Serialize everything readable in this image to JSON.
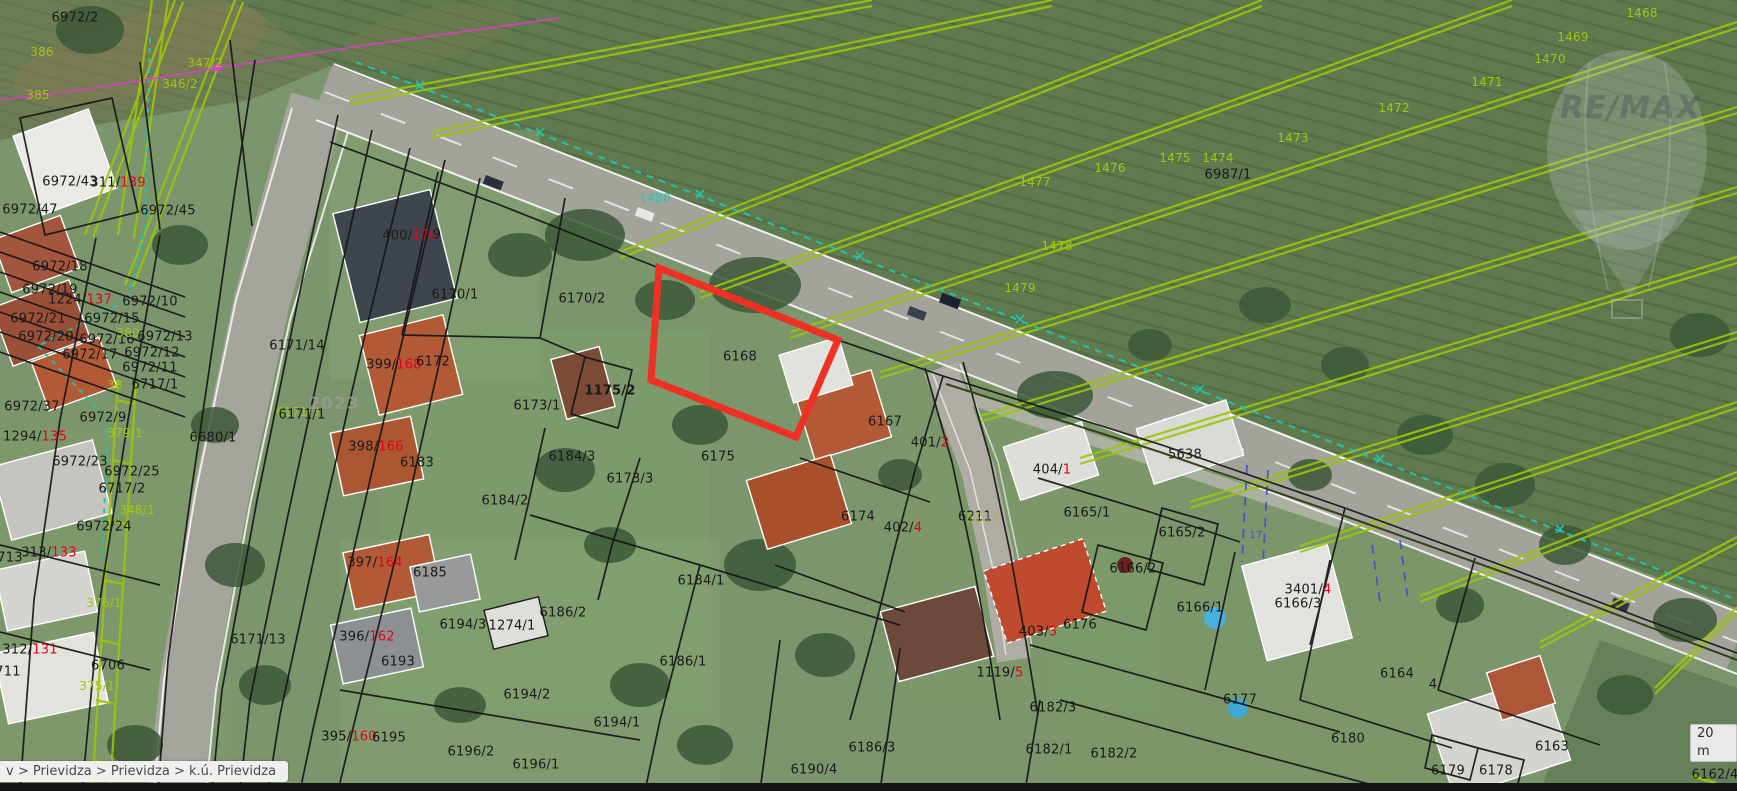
{
  "app": {
    "type": "cadastral-map-viewer"
  },
  "statusbar": {
    "breadcrumb": "v > Prievidza > Prievidza > k.ú. Prievidza"
  },
  "scale_indicator": {
    "label": "20 m"
  },
  "watermarks": {
    "brand": "RE/MAX",
    "imagery_year": "2023"
  },
  "map": {
    "highlight_parcel": {
      "id": "6168",
      "color": "#ee3124",
      "polygon": [
        [
          659,
          268
        ],
        [
          838,
          340
        ],
        [
          796,
          437
        ],
        [
          651,
          380
        ]
      ]
    },
    "label_colors": {
      "black": "#1a1a1a",
      "red": "#e4001f",
      "green": "#9fc80e",
      "teal": "#2bc4b2",
      "blue": "#4444cc"
    },
    "labels": [
      {
        "x": 75,
        "y": 18,
        "p": [
          [
            "6972/2",
            "black"
          ]
        ]
      },
      {
        "x": 70,
        "y": 182,
        "p": [
          [
            "6972/43",
            "black"
          ]
        ]
      },
      {
        "x": 118,
        "y": 183,
        "p": [
          [
            "311/",
            "black"
          ],
          [
            "139",
            "red"
          ]
        ]
      },
      {
        "x": 30,
        "y": 210,
        "p": [
          [
            "6972/47",
            "black"
          ]
        ]
      },
      {
        "x": 168,
        "y": 211,
        "p": [
          [
            "6972/45",
            "black"
          ]
        ]
      },
      {
        "x": 60,
        "y": 267,
        "p": [
          [
            "6972/18",
            "black"
          ]
        ]
      },
      {
        "x": 50,
        "y": 290,
        "p": [
          [
            "6972/19",
            "black"
          ]
        ]
      },
      {
        "x": 80,
        "y": 300,
        "p": [
          [
            "1224/",
            "black"
          ],
          [
            "137",
            "red"
          ]
        ]
      },
      {
        "x": 150,
        "y": 302,
        "p": [
          [
            "6972/10",
            "black"
          ]
        ]
      },
      {
        "x": 38,
        "y": 319,
        "p": [
          [
            "6972/21",
            "black"
          ]
        ]
      },
      {
        "x": 112,
        "y": 319,
        "p": [
          [
            "6972/15",
            "black"
          ]
        ]
      },
      {
        "x": 46,
        "y": 337,
        "p": [
          [
            "6972/20",
            "black"
          ]
        ]
      },
      {
        "x": 107,
        "y": 340,
        "p": [
          [
            "6972/16",
            "black"
          ]
        ]
      },
      {
        "x": 165,
        "y": 337,
        "p": [
          [
            "6972/13",
            "black"
          ]
        ]
      },
      {
        "x": 90,
        "y": 355,
        "p": [
          [
            "6972/17",
            "black"
          ]
        ]
      },
      {
        "x": 152,
        "y": 353,
        "p": [
          [
            "6972/12",
            "black"
          ]
        ]
      },
      {
        "x": 150,
        "y": 368,
        "p": [
          [
            "6972/11",
            "black"
          ]
        ]
      },
      {
        "x": 155,
        "y": 385,
        "p": [
          [
            "6717/1",
            "black"
          ]
        ]
      },
      {
        "x": 297,
        "y": 346,
        "p": [
          [
            "6171/14",
            "black"
          ]
        ]
      },
      {
        "x": 298,
        "y": 412,
        "p": [
          [
            "6171/3",
            "green"
          ]
        ],
        "s": 12
      },
      {
        "x": 302,
        "y": 415,
        "p": [
          [
            "6171/1",
            "black"
          ]
        ]
      },
      {
        "x": 32,
        "y": 407,
        "p": [
          [
            "6972/37",
            "black"
          ]
        ]
      },
      {
        "x": 35,
        "y": 437,
        "p": [
          [
            "1294/",
            "black"
          ],
          [
            "135",
            "red"
          ]
        ]
      },
      {
        "x": 103,
        "y": 418,
        "p": [
          [
            "6972/9",
            "black"
          ]
        ]
      },
      {
        "x": 213,
        "y": 438,
        "p": [
          [
            "6680/1",
            "black"
          ]
        ]
      },
      {
        "x": 80,
        "y": 462,
        "p": [
          [
            "6972/23",
            "black"
          ]
        ]
      },
      {
        "x": 132,
        "y": 472,
        "p": [
          [
            "6972/25",
            "black"
          ]
        ]
      },
      {
        "x": 122,
        "y": 489,
        "p": [
          [
            "6717/2",
            "black"
          ]
        ]
      },
      {
        "x": 104,
        "y": 527,
        "p": [
          [
            "6972/24",
            "black"
          ]
        ]
      },
      {
        "x": 10,
        "y": 558,
        "p": [
          [
            "713",
            "black"
          ]
        ]
      },
      {
        "x": 49,
        "y": 553,
        "p": [
          [
            "313/",
            "black"
          ],
          [
            "133",
            "red"
          ]
        ]
      },
      {
        "x": 30,
        "y": 650,
        "p": [
          [
            "312/",
            "black"
          ],
          [
            "131",
            "red"
          ]
        ]
      },
      {
        "x": 8,
        "y": 672,
        "p": [
          [
            "711",
            "black"
          ]
        ]
      },
      {
        "x": 108,
        "y": 666,
        "p": [
          [
            "6706",
            "black"
          ]
        ]
      },
      {
        "x": 258,
        "y": 640,
        "p": [
          [
            "6171/13",
            "black"
          ]
        ]
      },
      {
        "x": 410,
        "y": 236,
        "p": [
          [
            "400/",
            "black"
          ],
          [
            "170",
            "red"
          ]
        ]
      },
      {
        "x": 437,
        "y": 235,
        "p": [
          [
            "9",
            "black"
          ]
        ]
      },
      {
        "x": 455,
        "y": 295,
        "p": [
          [
            "6170/1",
            "black"
          ]
        ]
      },
      {
        "x": 582,
        "y": 299,
        "p": [
          [
            "6170/2",
            "black"
          ]
        ]
      },
      {
        "x": 394,
        "y": 365,
        "p": [
          [
            "399/",
            "black"
          ],
          [
            "168",
            "red"
          ]
        ]
      },
      {
        "x": 433,
        "y": 362,
        "p": [
          [
            "6172",
            "black"
          ]
        ]
      },
      {
        "x": 610,
        "y": 391,
        "p": [
          [
            "1175/2",
            "black"
          ]
        ],
        "b": 1
      },
      {
        "x": 537,
        "y": 406,
        "p": [
          [
            "6173/1",
            "black"
          ]
        ]
      },
      {
        "x": 740,
        "y": 357,
        "p": [
          [
            "6168",
            "black"
          ]
        ]
      },
      {
        "x": 572,
        "y": 457,
        "p": [
          [
            "6184/3",
            "black"
          ]
        ]
      },
      {
        "x": 630,
        "y": 479,
        "p": [
          [
            "6173/3",
            "black"
          ]
        ]
      },
      {
        "x": 718,
        "y": 457,
        "p": [
          [
            "6175",
            "black"
          ]
        ]
      },
      {
        "x": 376,
        "y": 447,
        "p": [
          [
            "398/",
            "black"
          ],
          [
            "166",
            "red"
          ]
        ]
      },
      {
        "x": 417,
        "y": 463,
        "p": [
          [
            "6183",
            "black"
          ]
        ]
      },
      {
        "x": 505,
        "y": 501,
        "p": [
          [
            "6184/2",
            "black"
          ]
        ]
      },
      {
        "x": 885,
        "y": 422,
        "p": [
          [
            "6167",
            "black"
          ]
        ]
      },
      {
        "x": 930,
        "y": 443,
        "p": [
          [
            "401/",
            "black"
          ],
          [
            "2",
            "red"
          ]
        ]
      },
      {
        "x": 858,
        "y": 517,
        "p": [
          [
            "6174",
            "black"
          ]
        ]
      },
      {
        "x": 903,
        "y": 528,
        "p": [
          [
            "402/",
            "black"
          ],
          [
            "4",
            "red"
          ]
        ]
      },
      {
        "x": 975,
        "y": 517,
        "p": [
          [
            "6211",
            "black"
          ]
        ]
      },
      {
        "x": 983,
        "y": 519,
        "p": [
          [
            "6211",
            "green"
          ]
        ],
        "o": 0.6
      },
      {
        "x": 1052,
        "y": 470,
        "p": [
          [
            "404/",
            "black"
          ],
          [
            "1",
            "red"
          ]
        ]
      },
      {
        "x": 1185,
        "y": 455,
        "p": [
          [
            "5638",
            "black"
          ]
        ]
      },
      {
        "x": 1087,
        "y": 513,
        "p": [
          [
            "6165/1",
            "black"
          ]
        ]
      },
      {
        "x": 1182,
        "y": 533,
        "p": [
          [
            "6165/2",
            "black"
          ]
        ]
      },
      {
        "x": 1133,
        "y": 569,
        "p": [
          [
            "6166/2",
            "black"
          ]
        ]
      },
      {
        "x": 1308,
        "y": 590,
        "p": [
          [
            "3401/",
            "black"
          ],
          [
            "4",
            "red"
          ]
        ]
      },
      {
        "x": 1298,
        "y": 604,
        "p": [
          [
            "6166/3",
            "black"
          ]
        ]
      },
      {
        "x": 1200,
        "y": 608,
        "p": [
          [
            "6166/1",
            "black"
          ]
        ]
      },
      {
        "x": 1080,
        "y": 625,
        "p": [
          [
            "6176",
            "black"
          ]
        ]
      },
      {
        "x": 1038,
        "y": 632,
        "p": [
          [
            "403/",
            "black"
          ],
          [
            "3",
            "red"
          ]
        ]
      },
      {
        "x": 1000,
        "y": 673,
        "p": [
          [
            "1119/",
            "black"
          ],
          [
            "5",
            "red"
          ]
        ]
      },
      {
        "x": 1053,
        "y": 708,
        "p": [
          [
            "6182/3",
            "black"
          ]
        ]
      },
      {
        "x": 1240,
        "y": 700,
        "p": [
          [
            "6177",
            "black"
          ]
        ]
      },
      {
        "x": 1348,
        "y": 739,
        "p": [
          [
            "6180",
            "black"
          ]
        ]
      },
      {
        "x": 1397,
        "y": 674,
        "p": [
          [
            "6164",
            "black"
          ]
        ]
      },
      {
        "x": 1552,
        "y": 747,
        "p": [
          [
            "6163",
            "black"
          ]
        ]
      },
      {
        "x": 1448,
        "y": 771,
        "p": [
          [
            "6179",
            "black"
          ]
        ]
      },
      {
        "x": 1496,
        "y": 771,
        "p": [
          [
            "6178",
            "black"
          ]
        ]
      },
      {
        "x": 1715,
        "y": 775,
        "p": [
          [
            "6162/4",
            "black"
          ]
        ]
      },
      {
        "x": 1433,
        "y": 685,
        "p": [
          [
            "4",
            "black"
          ]
        ]
      },
      {
        "x": 1228,
        "y": 175,
        "p": [
          [
            "6987/1",
            "black"
          ]
        ]
      },
      {
        "x": 375,
        "y": 563,
        "p": [
          [
            "397/",
            "black"
          ],
          [
            "164",
            "red"
          ]
        ]
      },
      {
        "x": 430,
        "y": 573,
        "p": [
          [
            "6185",
            "black"
          ]
        ]
      },
      {
        "x": 367,
        "y": 637,
        "p": [
          [
            "396/",
            "black"
          ],
          [
            "162",
            "red"
          ]
        ]
      },
      {
        "x": 398,
        "y": 662,
        "p": [
          [
            "6193",
            "black"
          ]
        ]
      },
      {
        "x": 463,
        "y": 625,
        "p": [
          [
            "6194/3",
            "black"
          ]
        ]
      },
      {
        "x": 512,
        "y": 626,
        "p": [
          [
            "1274/1",
            "black"
          ]
        ]
      },
      {
        "x": 563,
        "y": 613,
        "p": [
          [
            "6186/2",
            "black"
          ]
        ]
      },
      {
        "x": 527,
        "y": 695,
        "p": [
          [
            "6194/2",
            "black"
          ]
        ]
      },
      {
        "x": 349,
        "y": 737,
        "p": [
          [
            "395/",
            "black"
          ],
          [
            "160",
            "red"
          ]
        ]
      },
      {
        "x": 389,
        "y": 738,
        "p": [
          [
            "6195",
            "black"
          ]
        ]
      },
      {
        "x": 471,
        "y": 752,
        "p": [
          [
            "6196/2",
            "black"
          ]
        ]
      },
      {
        "x": 536,
        "y": 765,
        "p": [
          [
            "6196/1",
            "black"
          ]
        ]
      },
      {
        "x": 617,
        "y": 723,
        "p": [
          [
            "6194/1",
            "black"
          ]
        ]
      },
      {
        "x": 683,
        "y": 662,
        "p": [
          [
            "6186/1",
            "black"
          ]
        ]
      },
      {
        "x": 701,
        "y": 581,
        "p": [
          [
            "6184/1",
            "black"
          ]
        ]
      },
      {
        "x": 814,
        "y": 770,
        "p": [
          [
            "6190/4",
            "black"
          ]
        ]
      },
      {
        "x": 872,
        "y": 748,
        "p": [
          [
            "6186/3",
            "black"
          ]
        ]
      },
      {
        "x": 1049,
        "y": 750,
        "p": [
          [
            "6182/1",
            "black"
          ]
        ]
      },
      {
        "x": 1114,
        "y": 754,
        "p": [
          [
            "6182/2",
            "black"
          ]
        ]
      },
      {
        "x": 42,
        "y": 52,
        "p": [
          [
            "386",
            "green"
          ]
        ],
        "s": 12
      },
      {
        "x": 38,
        "y": 95,
        "p": [
          [
            "385",
            "green"
          ]
        ],
        "s": 12
      },
      {
        "x": 205,
        "y": 63,
        "p": [
          [
            "347/2",
            "green"
          ]
        ],
        "s": 12
      },
      {
        "x": 180,
        "y": 84,
        "p": [
          [
            "346/2",
            "green"
          ]
        ],
        "s": 12
      },
      {
        "x": 128,
        "y": 333,
        "p": [
          [
            "380",
            "green"
          ]
        ],
        "s": 12
      },
      {
        "x": 115,
        "y": 385,
        "p": [
          [
            "38",
            "green"
          ]
        ],
        "s": 12
      },
      {
        "x": 125,
        "y": 433,
        "p": [
          [
            "379/1",
            "green"
          ]
        ],
        "s": 12
      },
      {
        "x": 137,
        "y": 510,
        "p": [
          [
            "348/1",
            "green"
          ]
        ],
        "s": 12
      },
      {
        "x": 104,
        "y": 603,
        "p": [
          [
            "376/1",
            "green"
          ]
        ],
        "s": 12
      },
      {
        "x": 97,
        "y": 686,
        "p": [
          [
            "375/1",
            "green"
          ]
        ],
        "s": 12
      },
      {
        "x": 1642,
        "y": 13,
        "p": [
          [
            "1468",
            "green"
          ]
        ],
        "s": 12
      },
      {
        "x": 1573,
        "y": 37,
        "p": [
          [
            "1469",
            "green"
          ]
        ],
        "s": 12
      },
      {
        "x": 1550,
        "y": 59,
        "p": [
          [
            "1470",
            "green"
          ]
        ],
        "s": 12
      },
      {
        "x": 1487,
        "y": 82,
        "p": [
          [
            "1471",
            "green"
          ]
        ],
        "s": 12
      },
      {
        "x": 1394,
        "y": 108,
        "p": [
          [
            "1472",
            "green"
          ]
        ],
        "s": 12
      },
      {
        "x": 1293,
        "y": 138,
        "p": [
          [
            "1473",
            "green"
          ]
        ],
        "s": 12
      },
      {
        "x": 1218,
        "y": 158,
        "p": [
          [
            "1474",
            "green"
          ]
        ],
        "s": 12
      },
      {
        "x": 1175,
        "y": 158,
        "p": [
          [
            "1475",
            "green"
          ]
        ],
        "s": 12
      },
      {
        "x": 1110,
        "y": 168,
        "p": [
          [
            "1476",
            "green"
          ]
        ],
        "s": 12
      },
      {
        "x": 1035,
        "y": 182,
        "p": [
          [
            "1477",
            "green"
          ]
        ],
        "s": 12
      },
      {
        "x": 1057,
        "y": 246,
        "p": [
          [
            "1478",
            "green"
          ]
        ],
        "s": 12
      },
      {
        "x": 1020,
        "y": 288,
        "p": [
          [
            "1479",
            "green"
          ]
        ],
        "s": 12
      },
      {
        "x": 655,
        "y": 198,
        "p": [
          [
            "1480",
            "teal"
          ]
        ],
        "s": 12
      },
      {
        "x": 1256,
        "y": 536,
        "p": [
          [
            "17",
            "blue"
          ]
        ],
        "s": 10,
        "o": 0.85
      }
    ]
  }
}
